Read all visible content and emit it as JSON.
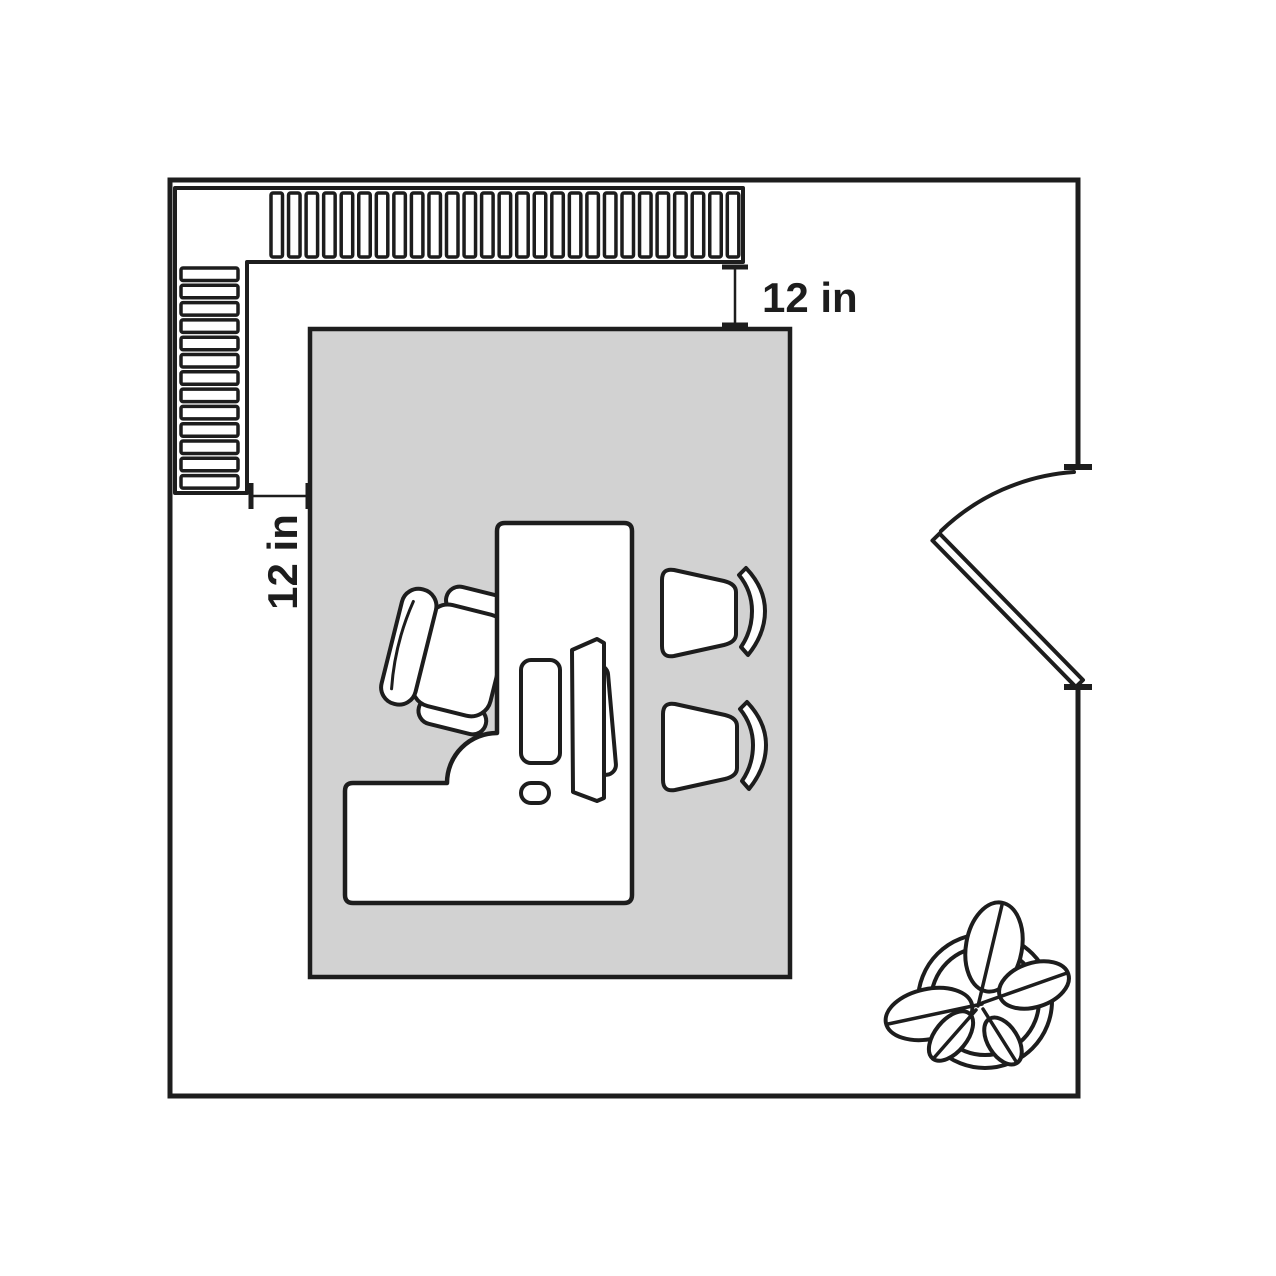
{
  "page": {
    "title": "Office floor plan with clearance dimensions"
  },
  "colors": {
    "outline": "#1d1d1d",
    "rug_fill": "#d2d2d2",
    "furniture_fill": "#ffffff",
    "page_background": "#ffffff"
  },
  "annotations": {
    "top_clearance": {
      "label": "12 in"
    },
    "left_clearance": {
      "label": "12 in"
    }
  },
  "shelves": {
    "top_slat_count": 27,
    "left_slat_count": 13
  },
  "items": [
    "room-walls",
    "bookshelf-top",
    "bookshelf-left",
    "rug",
    "l-shaped-desk",
    "office-chair",
    "guest-chair-top",
    "guest-chair-bottom",
    "monitor",
    "keyboard",
    "mouse",
    "door-leaf",
    "door-swing-arc",
    "potted-plant"
  ]
}
